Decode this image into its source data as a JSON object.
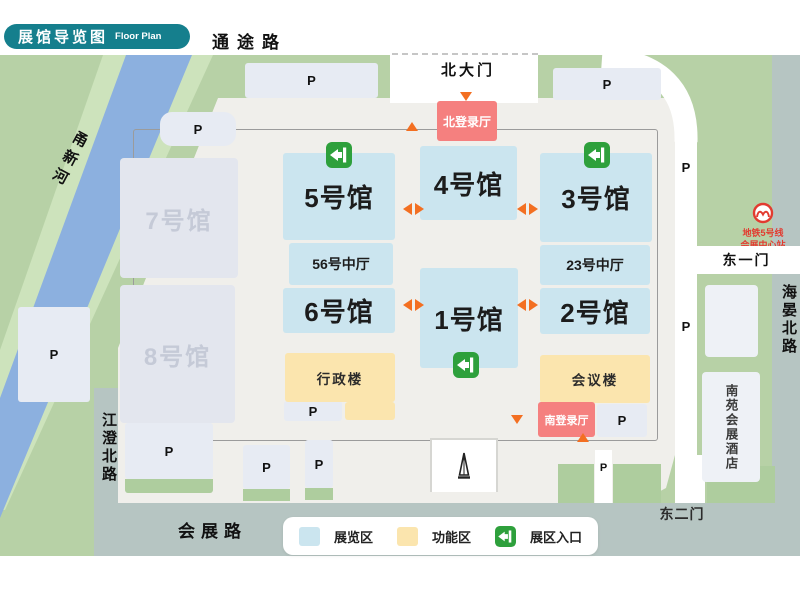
{
  "title": {
    "zh": "展馆导览图",
    "en": "Floor Plan"
  },
  "roads": {
    "north": "通途路",
    "south": "会展路",
    "west": "江澄北路",
    "east": "海晏北路"
  },
  "river": {
    "name": "甬新河"
  },
  "gates": {
    "north": "北大门",
    "east1": "东一门",
    "east2": "东二门"
  },
  "halls": {
    "h5": "5号馆",
    "h4": "4号馆",
    "h3": "3号馆",
    "h56": "56号中厅",
    "h23": "23号中厅",
    "h6": "6号馆",
    "h1": "1号馆",
    "h2": "2号馆",
    "h7": "7号馆",
    "h8": "8号馆"
  },
  "facilities": {
    "admin": "行政楼",
    "conference": "会议楼",
    "north_login": "北登录厅",
    "south_login": "南登录厅",
    "hotel": "南苑会展酒店"
  },
  "metro": {
    "line": "地铁5号线",
    "station": "会展中心站"
  },
  "parking_label": "P",
  "legend": {
    "exhibition": "展览区",
    "function": "功能区",
    "entrance": "展区入口"
  },
  "colors": {
    "exhibition_blue": "#cbe5ef",
    "function_yellow": "#fbe5ae",
    "entrance_green": "#2ea03c",
    "login_red": "#f5807f",
    "arrow_orange": "#f36f21",
    "banner_teal": "#157f8d",
    "metro_red": "#e23b30"
  }
}
